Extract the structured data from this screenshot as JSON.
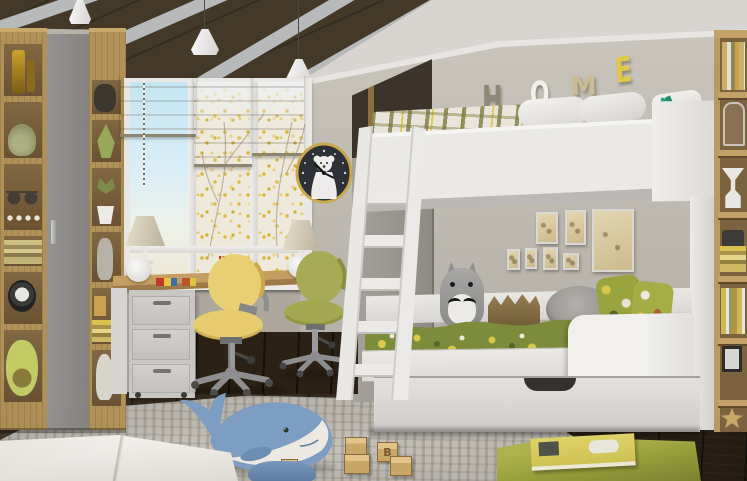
{
  "scene": {
    "kind": "photorealistic render of a children's bedroom",
    "wall_letters": {
      "word": [
        "H",
        "O",
        "M",
        "E"
      ]
    },
    "toy_block": {
      "letter": "B"
    },
    "objects": [
      "wood plank ceiling with gray beams",
      "white pendant lamps",
      "tall oak shelving with toys",
      "gray wardrobe door",
      "window with roman shades and autumn trees",
      "polar bear wall clock",
      "desk with drawer unit",
      "yellow swivel chair",
      "olive swivel chair",
      "white bunk bed with ladder and storage drawer",
      "jungle print duvet",
      "plush cat pillow",
      "framed vintage sketches",
      "oak bookshelf with books",
      "gray area rug",
      "whale plush toy",
      "wooden letter blocks",
      "white floor cushion",
      "green ottoman with picture book",
      "blue cushion"
    ],
    "palette": {
      "wall": "#b2aca3",
      "back_wall": "#c4bfb6",
      "ceiling_wood": "#443927",
      "beam": "#b7b9bb",
      "bed_white": "#eae9e6",
      "roman_shade": "#a89f86",
      "desk_wood": "#b8945a",
      "chair_yellow": "#e7cf72",
      "chair_olive": "#a8ab55",
      "duvet_green": "#7d8c3a",
      "accent_yellow": "#d9c645",
      "rug": "#b9b5ad",
      "floor": "#33271a",
      "whale_blue": "#7e9dc2",
      "ottoman_green": "#9aa23c",
      "clock_gold": "#c9a94f",
      "letter_h": "#8b8876",
      "letter_o": "#f2f0ea",
      "letter_m": "#ccbc93",
      "letter_e": "#e0c84a"
    }
  }
}
